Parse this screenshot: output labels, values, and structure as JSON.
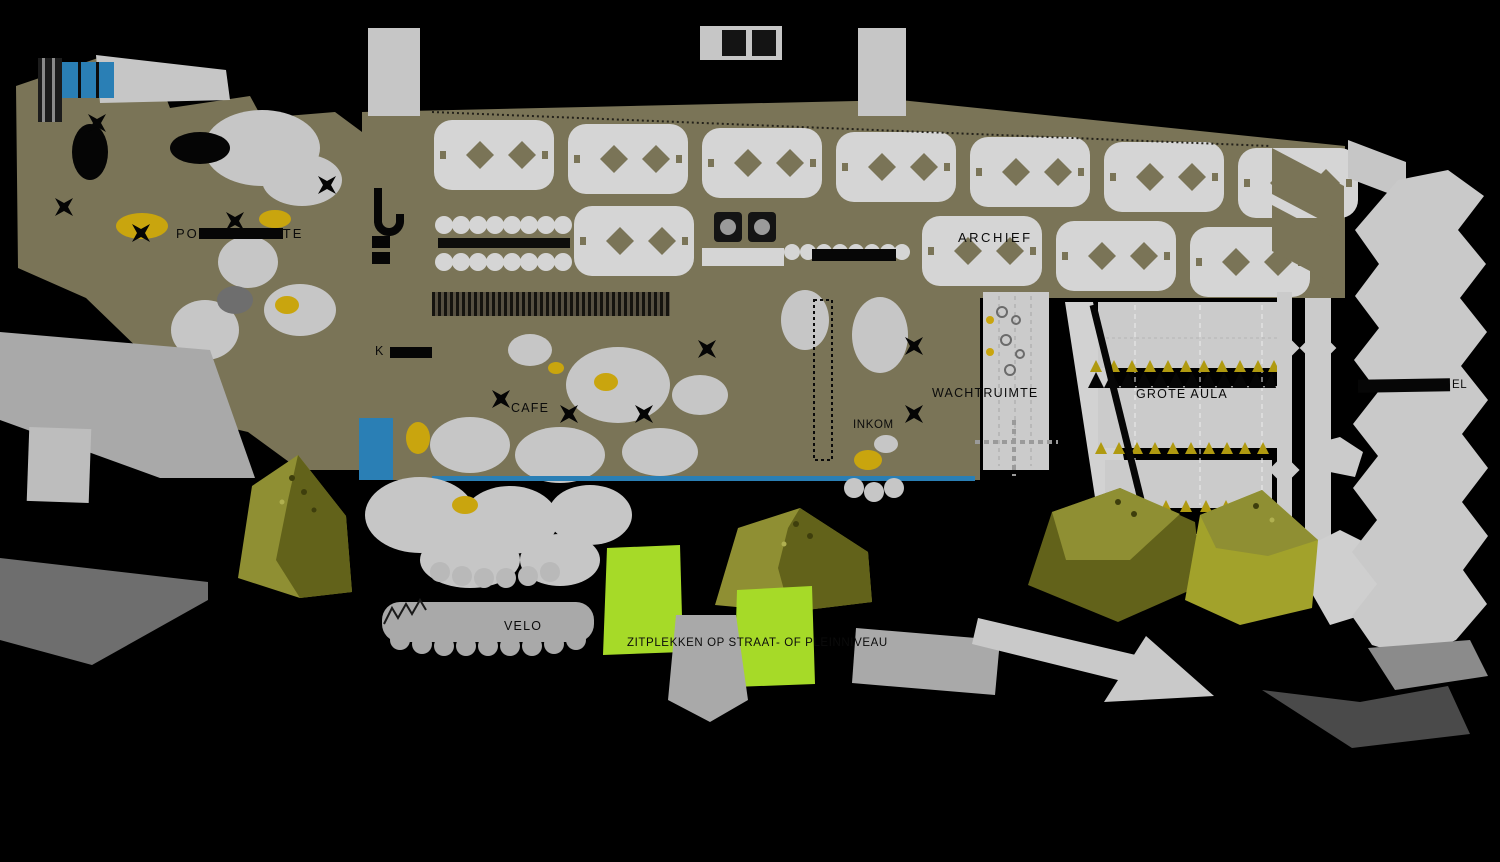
{
  "colors": {
    "background": "#000000",
    "olive_floor": "#7a7457",
    "shelf_gray": "#d5d5d5",
    "blob_gray": "#c6c6c6",
    "room_gray": "#cbcbcb",
    "plaza_gray": "#a9a9a9",
    "mid_gray": "#6e6e6e",
    "dark_gray": "#4a4a4a",
    "blue": "#2a7fb5",
    "yellow": "#c9a50e",
    "lime": "#a6da28",
    "tree_light": "#8f8f33",
    "tree_dark": "#62621a",
    "tree_bright": "#a2a22b",
    "seat_gold": "#b09a10"
  },
  "labels": {
    "left_room": {
      "prefix": "PO",
      "suffix": "TE"
    },
    "archief": "ARCHIEF",
    "wachtruimte": "WACHTRUIMTE",
    "grote_aula": "GROTE AULA",
    "inkom": "INKOM",
    "cafe": "CAFE",
    "keuken_initial": "K",
    "velo": "VELO",
    "zitplekken": "ZITPLEKKEN OP STRAAT- OF PLEINNIVEAU",
    "right_building_fragment": "EL"
  }
}
